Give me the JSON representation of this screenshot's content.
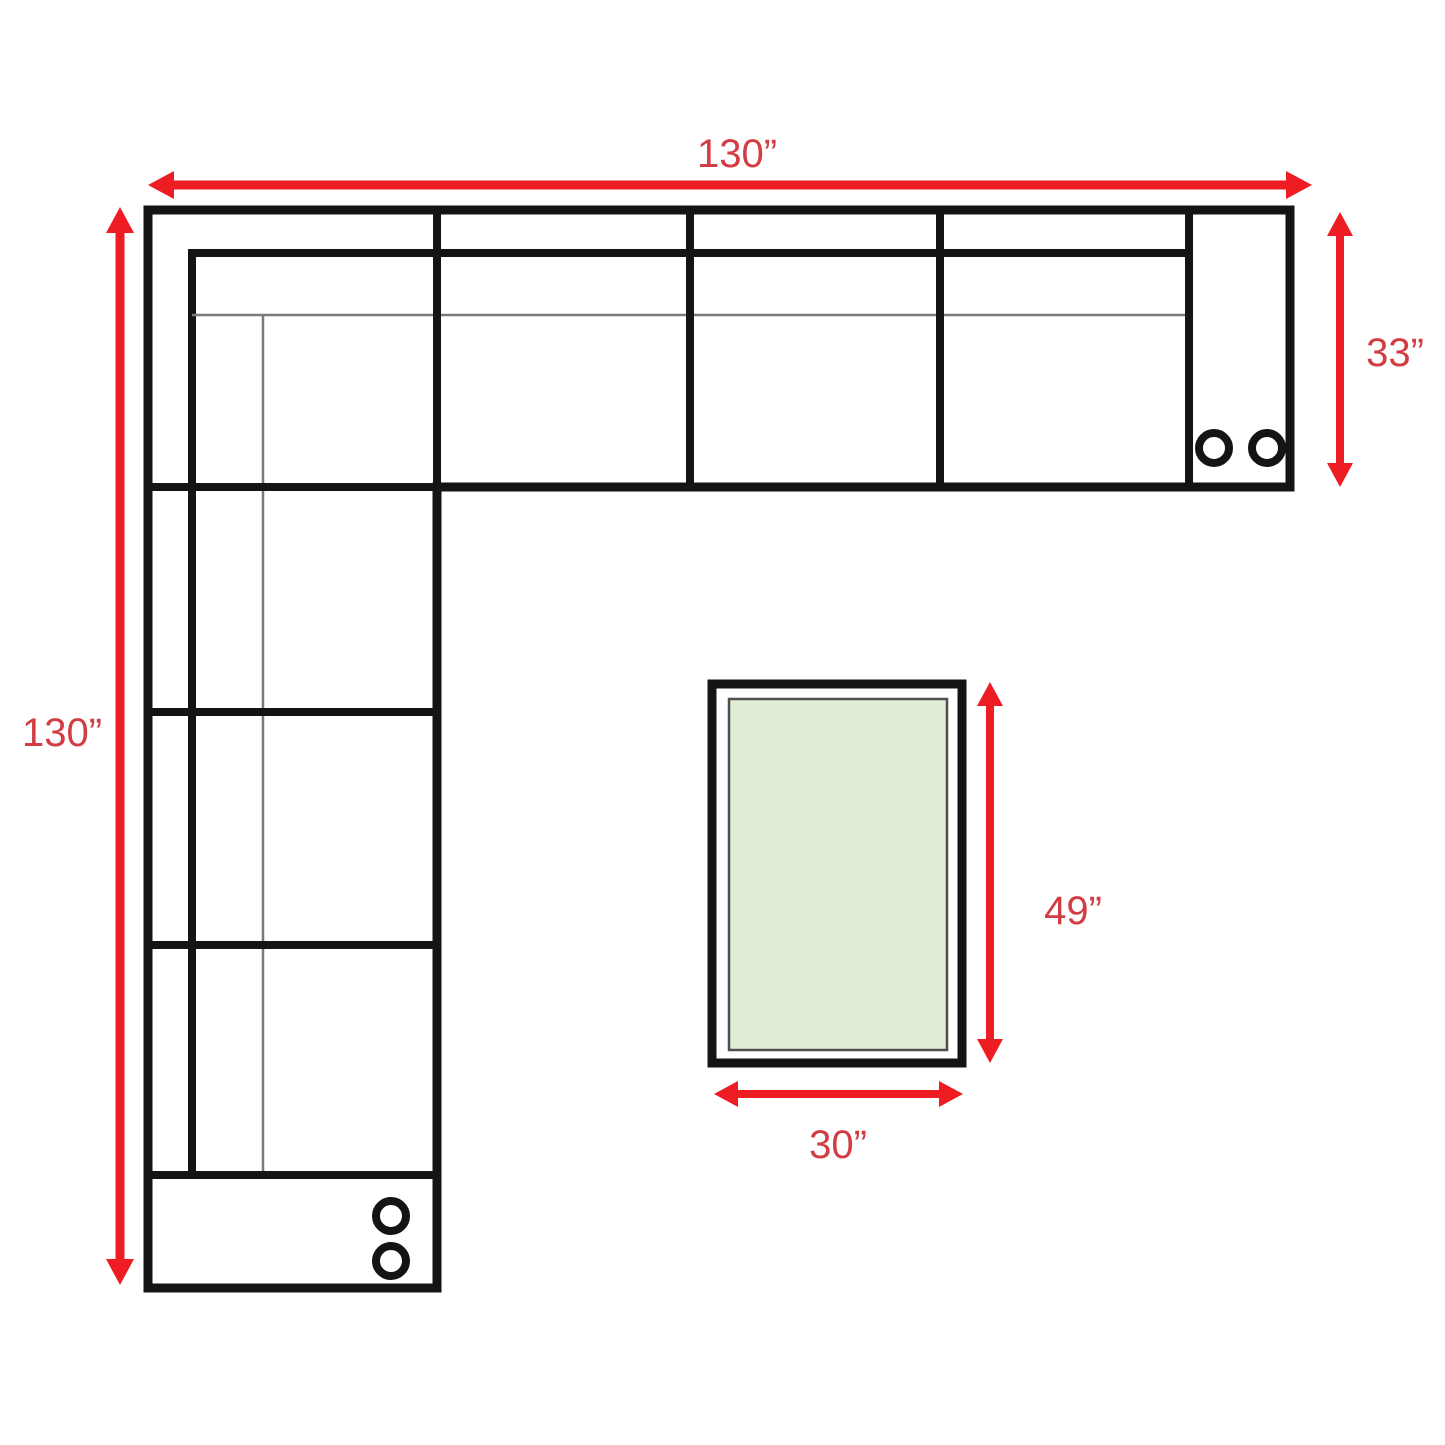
{
  "diagram": {
    "kind": "sectional-sofa-floor-plan",
    "labels": {
      "sofa_width": "130”",
      "sofa_height": "130”",
      "sofa_depth": "33”",
      "table_length": "49”",
      "table_width": "30”"
    },
    "colors": {
      "dimension_arrow": "#ee1c23",
      "dimension_label": "#d23c43",
      "sofa_outline": "#141414",
      "seat_edge_line": "#7b7b7b",
      "table_inner_border": "#4f4f4f",
      "table_fill": "#e1eed7",
      "background": "#ffffff"
    },
    "icons": {
      "cup_holder": "circle-outline",
      "arrowhead": "triangle"
    }
  }
}
